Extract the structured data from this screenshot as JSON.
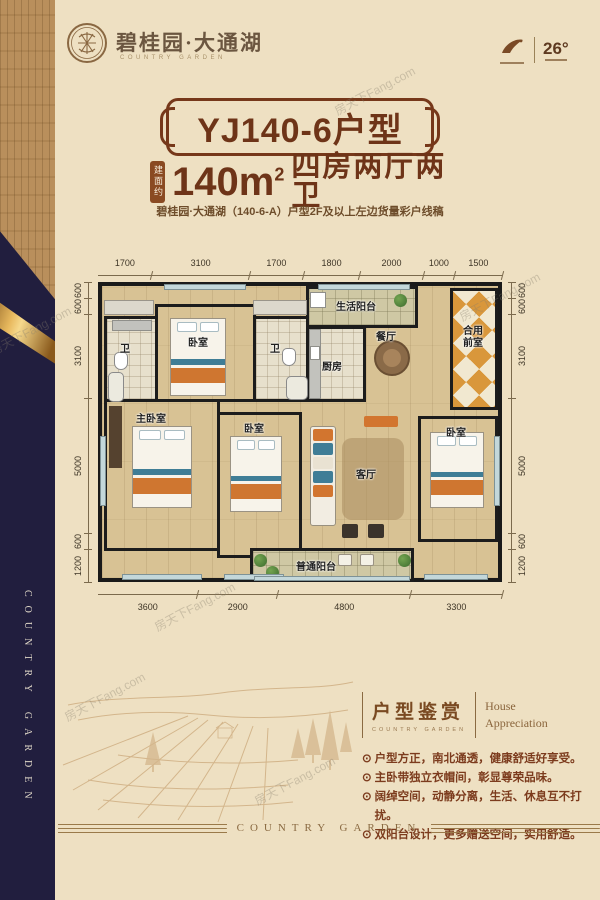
{
  "brand": {
    "name": "碧桂园·大通湖",
    "tagline": "COUNTRY GARDEN",
    "temp": "26°"
  },
  "title": {
    "text": "YJ140-6户型"
  },
  "area": {
    "badge": "建面约",
    "value": "140m",
    "sup": "2",
    "layout": "四房两厅两卫"
  },
  "subtitle": "碧桂园·大通湖（140-6-A）户型2F及以上左边货量彩户线稿",
  "plan": {
    "dims_top": [
      "1700",
      "3100",
      "1700",
      "1800",
      "2000",
      "1000",
      "1500"
    ],
    "dims_bottom": [
      "3600",
      "2900",
      "4800",
      "3300"
    ],
    "dims_left": [
      "600",
      "600",
      "3100",
      "5000",
      "600",
      "1200"
    ],
    "dims_right": [
      "600",
      "600",
      "3100",
      "5000",
      "600",
      "1200"
    ],
    "rooms": {
      "bath1": "卫",
      "bedroom_top": "卧室",
      "bath2": "卫",
      "kitchen": "厨房",
      "life_balcony": "生活阳台",
      "dining": "餐厅",
      "lobby": "合用前室",
      "master": "主卧室",
      "bedroom2": "卧室",
      "living": "客厅",
      "bedroom3": "卧室",
      "balcony": "普通阳台"
    }
  },
  "appreciation": {
    "title": "户型鉴赏",
    "subtitle": "COUNTRY GARDEN",
    "en1": "House",
    "en2": "Appreciation",
    "marker": "⊙",
    "bullets": [
      "户型方正，南北通透，健康舒适好享受。",
      "主卧带独立衣帽间，彰显尊荣品味。",
      "阔绰空间，动静分离，生活、休息互不打扰。",
      "双阳台设计，更多赠送空间，实用舒适。"
    ]
  },
  "sidebar": {
    "vertical_text": "COUNTRY GARDEN"
  },
  "footer": {
    "text": "COUNTRY GARDEN"
  },
  "watermark": {
    "text": "房天下Fang.com"
  },
  "colors": {
    "brown": "#6e3418",
    "navy": "#211e3e",
    "gold": "#d8a84f",
    "wall": "#1a1a1a",
    "accent_orange": "#d2752f",
    "background": "#eee0c2"
  }
}
